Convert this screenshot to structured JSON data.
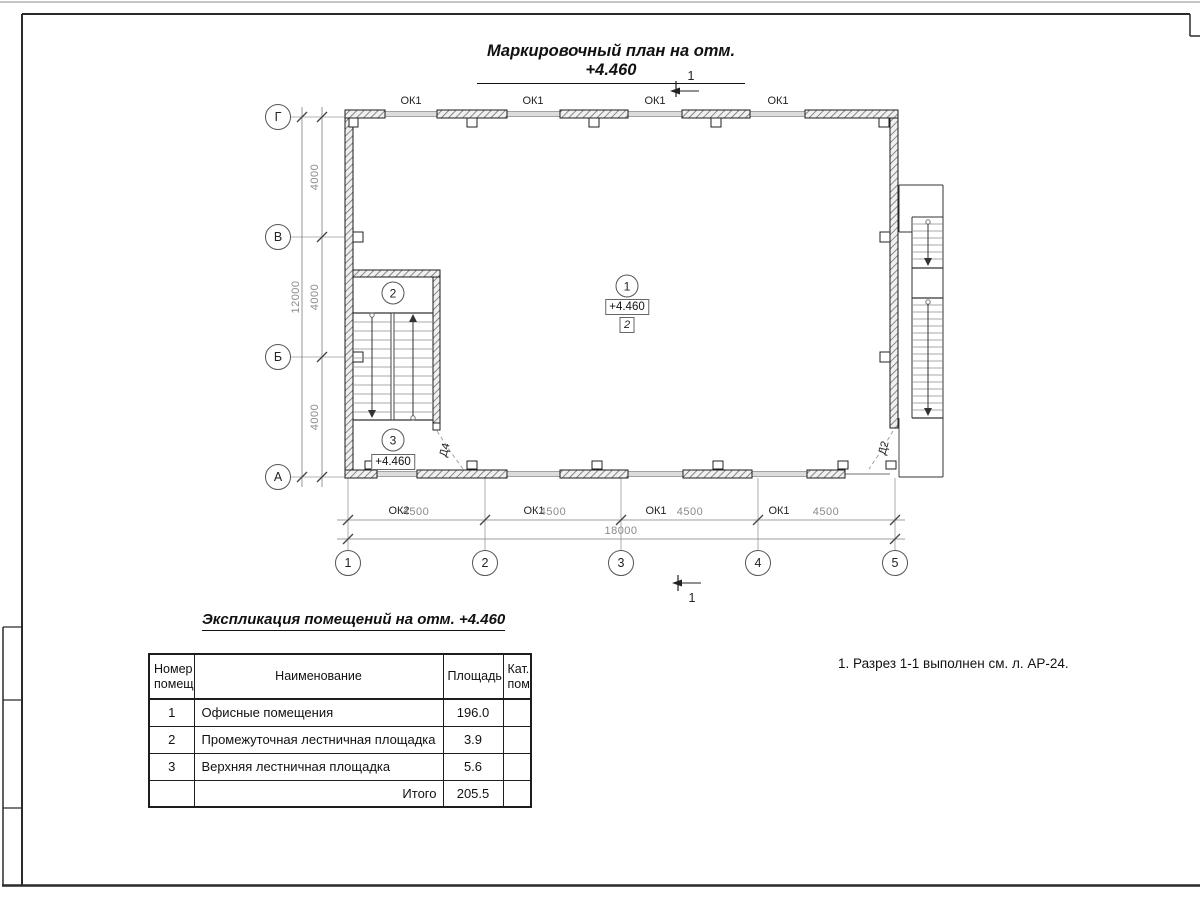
{
  "sheet": {
    "title": "Маркировочный план на отм. +4.460",
    "note": "1. Разрез 1-1 выполнен см. л. АР-24."
  },
  "plan": {
    "axes_rows": [
      "Г",
      "В",
      "Б",
      "А"
    ],
    "axes_cols": [
      "1",
      "2",
      "3",
      "4",
      "5"
    ],
    "dim_col": "4500",
    "dim_col_total": "18000",
    "dim_row": "4000",
    "dim_row_total": "12000",
    "window_ok1": "ОК1",
    "window_ok2": "ОК2",
    "door_d4": "Д4",
    "door_d2": "Д2",
    "room1": "1",
    "room2": "2",
    "room3": "3",
    "elevation": "+4.460",
    "floor_type": "2",
    "section_mark": "1"
  },
  "schedule": {
    "title": "Экспликация помещений на отм. +4.460",
    "headers": {
      "num": "Номер помещ.",
      "name": "Наименование",
      "area": "Площадь",
      "cat": "Кат. пом."
    },
    "rows": [
      {
        "num": "1",
        "name": "Офисные помещения",
        "area": "196.0",
        "cat": ""
      },
      {
        "num": "2",
        "name": "Промежуточная лестничная площадка",
        "area": "3.9",
        "cat": ""
      },
      {
        "num": "3",
        "name": "Верхняя лестничная площадка",
        "area": "5.6",
        "cat": ""
      }
    ],
    "total_label": "Итого",
    "total_area": "205.5"
  }
}
